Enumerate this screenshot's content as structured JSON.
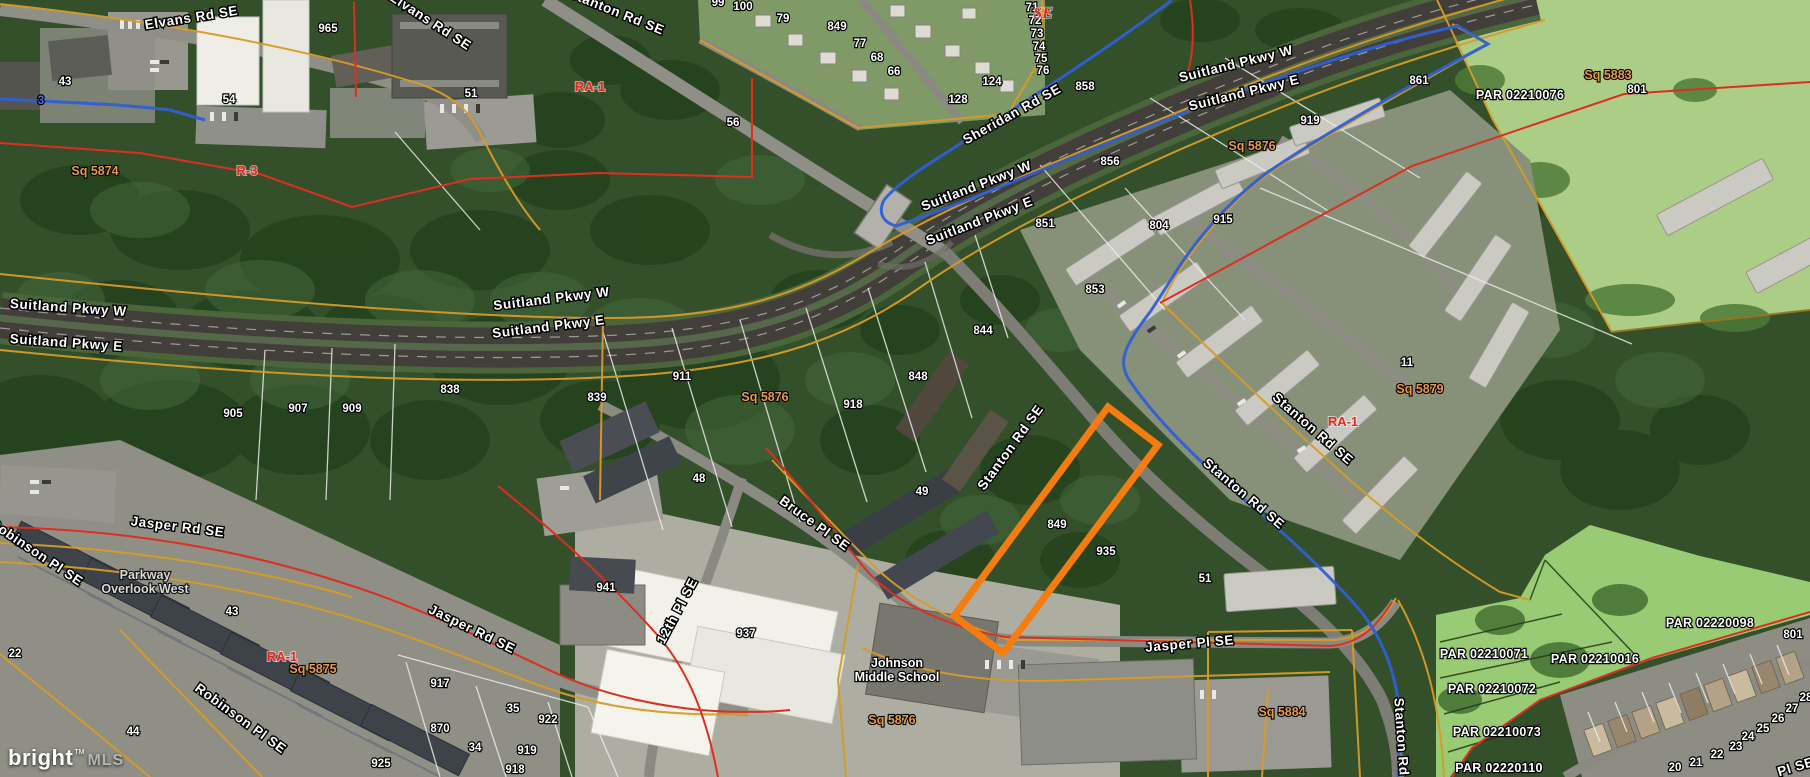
{
  "map": {
    "watermark": {
      "brand": "bright",
      "tm": "TM",
      "suffix": "MLS"
    },
    "colors": {
      "route_blue": "#2f5fd6",
      "boundary_red": "#dd2f1f",
      "boundary_gold": "#d79b28",
      "lot_line_white": "#eeeeee",
      "zoning_red": "#e8281e",
      "square_orange": "#e89a45",
      "subject_orange": "#f57c0e"
    },
    "subject_parcel": {
      "points": [
        [
          1108,
          407
        ],
        [
          1158,
          445
        ],
        [
          1003,
          653
        ],
        [
          954,
          616
        ]
      ],
      "color": "#f57c0e"
    },
    "labels": {
      "roads": [
        {
          "text": "Elvans Rd SE",
          "x": 192,
          "y": 22,
          "rot": -9
        },
        {
          "text": "Elvans Rd SE",
          "x": 428,
          "y": 25,
          "rot": 33
        },
        {
          "text": "Stanton Rd SE",
          "x": 615,
          "y": 16,
          "rot": 22
        },
        {
          "text": "Sheridan Rd SE",
          "x": 1014,
          "y": 118,
          "rot": -29
        },
        {
          "text": "Suitland Pkwy W",
          "x": 1237,
          "y": 68,
          "rot": -14
        },
        {
          "text": "Suitland Pkwy E",
          "x": 1245,
          "y": 97,
          "rot": -14
        },
        {
          "text": "Suitland Pkwy W",
          "x": 978,
          "y": 190,
          "rot": -21
        },
        {
          "text": "Suitland Pkwy E",
          "x": 981,
          "y": 225,
          "rot": -21
        },
        {
          "text": "Suitland Pkwy W",
          "x": 552,
          "y": 303,
          "rot": -7
        },
        {
          "text": "Suitland Pkwy E",
          "x": 549,
          "y": 331,
          "rot": -7
        },
        {
          "text": "Suitland Pkwy W",
          "x": 68,
          "y": 312,
          "rot": 4
        },
        {
          "text": "Suitland Pkwy E",
          "x": 66,
          "y": 347,
          "rot": 4
        },
        {
          "text": "Stanton Rd SE",
          "x": 1014,
          "y": 450,
          "rot": -54
        },
        {
          "text": "Stanton Rd SE",
          "x": 1310,
          "y": 432,
          "rot": 41
        },
        {
          "text": "Stanton Rd SE",
          "x": 1241,
          "y": 497,
          "rot": 40
        },
        {
          "text": "Stanton Rd",
          "x": 1397,
          "y": 737,
          "rot": 86
        },
        {
          "text": "Jasper Rd SE",
          "x": 177,
          "y": 531,
          "rot": 7
        },
        {
          "text": "Jasper Rd SE",
          "x": 470,
          "y": 633,
          "rot": 26
        },
        {
          "text": "Jasper Pl SE",
          "x": 1190,
          "y": 648,
          "rot": -5
        },
        {
          "text": "Bruce Pl SE",
          "x": 812,
          "y": 527,
          "rot": 36
        },
        {
          "text": "12th Pl SE",
          "x": 681,
          "y": 613,
          "rot": -62
        },
        {
          "text": "Robinson Pl SE",
          "x": 34,
          "y": 556,
          "rot": 34
        },
        {
          "text": "Robinson Pl SE",
          "x": 238,
          "y": 722,
          "rot": 36
        },
        {
          "text": "Pl SE",
          "x": 1797,
          "y": 771,
          "rot": -17
        }
      ],
      "numbers": [
        {
          "text": "43",
          "x": 65,
          "y": 85
        },
        {
          "text": "54",
          "x": 229,
          "y": 103
        },
        {
          "text": "3",
          "x": 41,
          "y": 104,
          "color": "#4f6fdd"
        },
        {
          "text": "965",
          "x": 328,
          "y": 32
        },
        {
          "text": "51",
          "x": 471,
          "y": 97
        },
        {
          "text": "56",
          "x": 733,
          "y": 126
        },
        {
          "text": "99",
          "x": 718,
          "y": 6
        },
        {
          "text": "100",
          "x": 743,
          "y": 10
        },
        {
          "text": "79",
          "x": 783,
          "y": 22
        },
        {
          "text": "849",
          "x": 837,
          "y": 30
        },
        {
          "text": "77",
          "x": 860,
          "y": 47
        },
        {
          "text": "68",
          "x": 877,
          "y": 61
        },
        {
          "text": "66",
          "x": 894,
          "y": 75
        },
        {
          "text": "71",
          "x": 1032,
          "y": 11
        },
        {
          "text": "72",
          "x": 1035,
          "y": 24
        },
        {
          "text": "73",
          "x": 1037,
          "y": 37
        },
        {
          "text": "74",
          "x": 1039,
          "y": 50
        },
        {
          "text": "75",
          "x": 1041,
          "y": 62
        },
        {
          "text": "76",
          "x": 1043,
          "y": 74
        },
        {
          "text": "124",
          "x": 992,
          "y": 85
        },
        {
          "text": "128",
          "x": 958,
          "y": 103
        },
        {
          "text": "858",
          "x": 1085,
          "y": 90
        },
        {
          "text": "856",
          "x": 1110,
          "y": 165
        },
        {
          "text": "851",
          "x": 1045,
          "y": 227
        },
        {
          "text": "804",
          "x": 1159,
          "y": 229
        },
        {
          "text": "853",
          "x": 1095,
          "y": 293
        },
        {
          "text": "915",
          "x": 1223,
          "y": 223
        },
        {
          "text": "919",
          "x": 1310,
          "y": 124
        },
        {
          "text": "861",
          "x": 1419,
          "y": 84
        },
        {
          "text": "801",
          "x": 1637,
          "y": 93
        },
        {
          "text": "844",
          "x": 983,
          "y": 334
        },
        {
          "text": "848",
          "x": 918,
          "y": 380
        },
        {
          "text": "918",
          "x": 853,
          "y": 408
        },
        {
          "text": "911",
          "x": 682,
          "y": 380
        },
        {
          "text": "839",
          "x": 597,
          "y": 401
        },
        {
          "text": "838",
          "x": 450,
          "y": 393
        },
        {
          "text": "905",
          "x": 233,
          "y": 417
        },
        {
          "text": "907",
          "x": 298,
          "y": 412
        },
        {
          "text": "909",
          "x": 352,
          "y": 412
        },
        {
          "text": "48",
          "x": 699,
          "y": 482
        },
        {
          "text": "49",
          "x": 922,
          "y": 495
        },
        {
          "text": "849",
          "x": 1057,
          "y": 528
        },
        {
          "text": "935",
          "x": 1106,
          "y": 555
        },
        {
          "text": "941",
          "x": 606,
          "y": 591
        },
        {
          "text": "937",
          "x": 746,
          "y": 637
        },
        {
          "text": "51",
          "x": 1205,
          "y": 582
        },
        {
          "text": "11",
          "x": 1407,
          "y": 366
        },
        {
          "text": "43",
          "x": 232,
          "y": 615
        },
        {
          "text": "22",
          "x": 15,
          "y": 657
        },
        {
          "text": "44",
          "x": 133,
          "y": 735
        },
        {
          "text": "917",
          "x": 440,
          "y": 687
        },
        {
          "text": "35",
          "x": 513,
          "y": 712
        },
        {
          "text": "870",
          "x": 440,
          "y": 732
        },
        {
          "text": "34",
          "x": 475,
          "y": 751
        },
        {
          "text": "925",
          "x": 381,
          "y": 767
        },
        {
          "text": "922",
          "x": 548,
          "y": 723
        },
        {
          "text": "919",
          "x": 527,
          "y": 754
        },
        {
          "text": "918",
          "x": 515,
          "y": 773
        },
        {
          "text": "20",
          "x": 1675,
          "y": 771
        },
        {
          "text": "21",
          "x": 1696,
          "y": 766
        },
        {
          "text": "22",
          "x": 1717,
          "y": 758
        },
        {
          "text": "23",
          "x": 1736,
          "y": 750
        },
        {
          "text": "24",
          "x": 1748,
          "y": 740
        },
        {
          "text": "25",
          "x": 1763,
          "y": 732
        },
        {
          "text": "26",
          "x": 1778,
          "y": 722
        },
        {
          "text": "27",
          "x": 1792,
          "y": 712
        },
        {
          "text": "28",
          "x": 1806,
          "y": 701
        },
        {
          "text": "801",
          "x": 1793,
          "y": 638
        }
      ],
      "zoning": [
        {
          "text": "SE",
          "x": 1043,
          "y": 18,
          "style": "se"
        },
        {
          "text": "R-3",
          "x": 247,
          "y": 175
        },
        {
          "text": "RA-1",
          "x": 590,
          "y": 91
        },
        {
          "text": "RA-1",
          "x": 282,
          "y": 661
        },
        {
          "text": "RA-1",
          "x": 1343,
          "y": 426
        }
      ],
      "squares": [
        {
          "text": "Sq 5874",
          "x": 95,
          "y": 175
        },
        {
          "text": "Sq 5876",
          "x": 765,
          "y": 401
        },
        {
          "text": "Sq 5876",
          "x": 1252,
          "y": 150
        },
        {
          "text": "Sq 5876",
          "x": 892,
          "y": 724
        },
        {
          "text": "Sq 5875",
          "x": 313,
          "y": 673
        },
        {
          "text": "Sq 5879",
          "x": 1420,
          "y": 393
        },
        {
          "text": "Sq 5883",
          "x": 1608,
          "y": 79
        },
        {
          "text": "Sq 5884",
          "x": 1282,
          "y": 716
        }
      ],
      "parcels": [
        {
          "text": "PAR 02210076",
          "x": 1520,
          "y": 99
        },
        {
          "text": "PAR 02220098",
          "x": 1710,
          "y": 627
        },
        {
          "text": "PAR 02210071",
          "x": 1484,
          "y": 658
        },
        {
          "text": "PAR 02210016",
          "x": 1595,
          "y": 663
        },
        {
          "text": "PAR 02210072",
          "x": 1492,
          "y": 693
        },
        {
          "text": "PAR 02210073",
          "x": 1497,
          "y": 736
        },
        {
          "text": "PAR 02220110",
          "x": 1499,
          "y": 772
        }
      ],
      "places": [
        {
          "lines": [
            "Johnson",
            "Middle School"
          ],
          "x": 897,
          "y": 667,
          "cls": "school"
        },
        {
          "lines": [
            "Parkway",
            "Overlook West"
          ],
          "x": 145,
          "y": 579,
          "cls": "district"
        }
      ]
    }
  }
}
